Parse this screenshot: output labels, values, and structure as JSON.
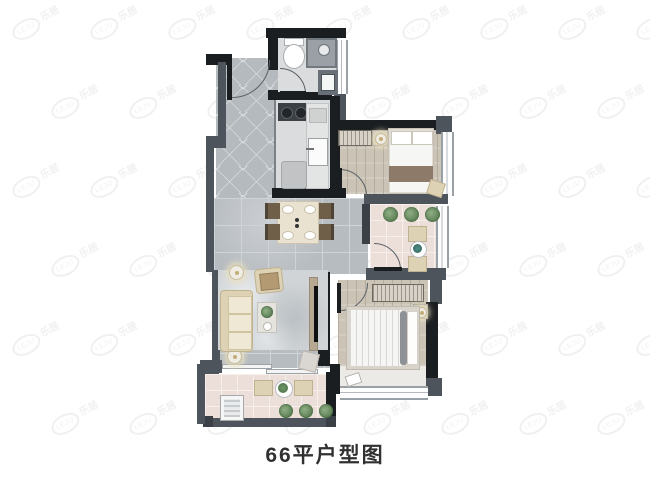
{
  "caption": {
    "text": "66平户型图"
  },
  "watermark": {
    "brand_text": "乐居",
    "logo_text": "LEJU"
  },
  "colors": {
    "wall_gray": "#4d545b",
    "wall_black": "#1b1e21",
    "tile_gray": "#b7bcc1",
    "wood_floor": "#cbc4b6",
    "balcony_pink": "#ecdfda",
    "sofa_beige": "#ddd2b3",
    "plant_green": "#5d8055",
    "shower_tile": "#9aa0a5"
  }
}
